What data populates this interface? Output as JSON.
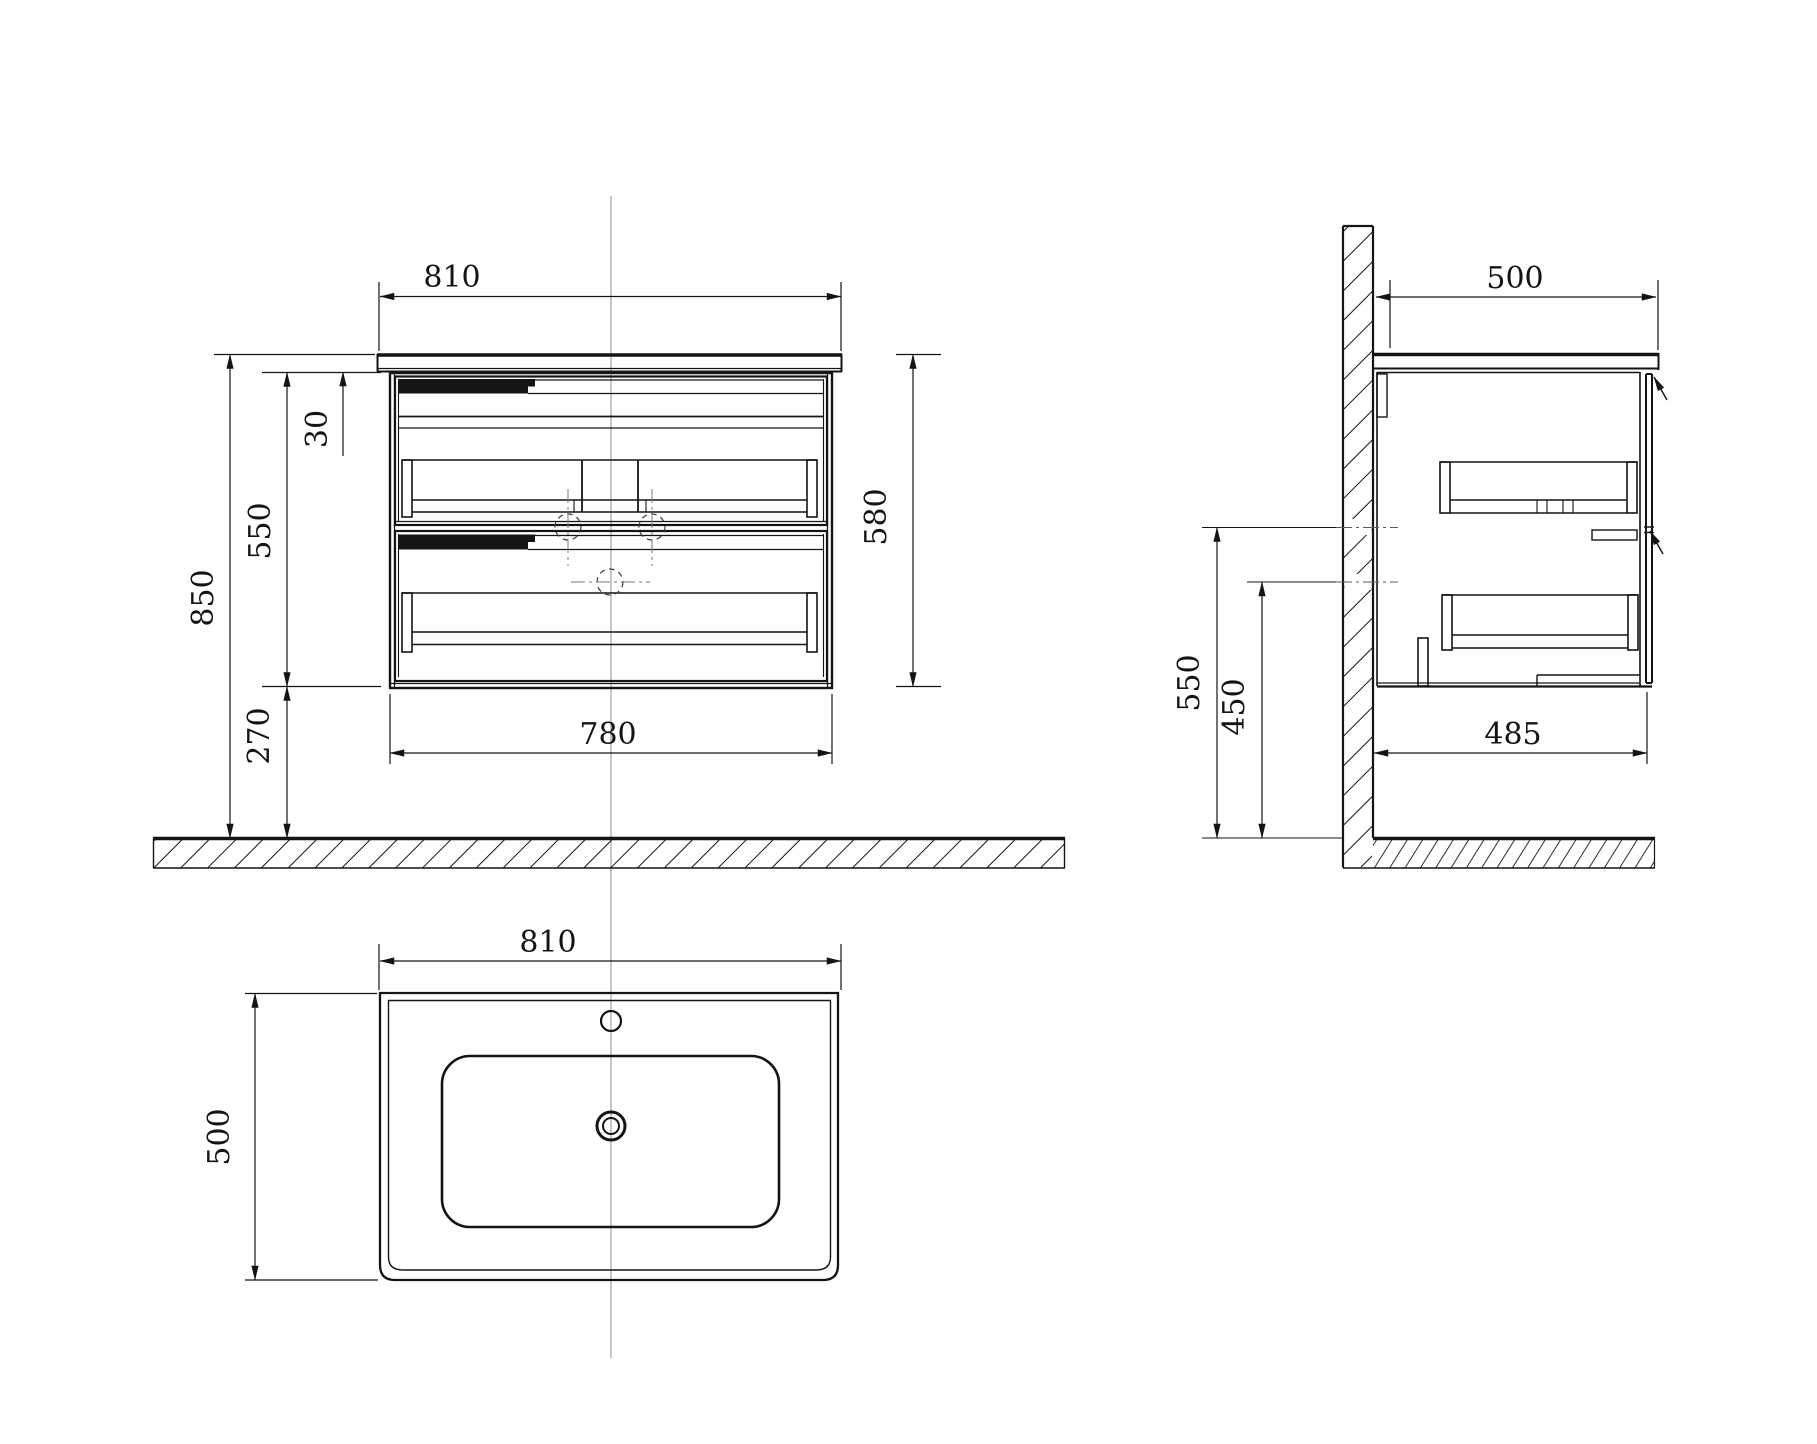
{
  "drawing": {
    "type": "technical-drawing",
    "subject": "wall-hung bathroom vanity cabinet with ceramic basin",
    "views": {
      "front": {
        "label": "front-view",
        "dims": {
          "top_width": "810",
          "counter_thickness": "30",
          "cabinet_height": "550",
          "overall_height": "850",
          "floor_clearance": "270",
          "cabinet_width": "780",
          "front_height": "580"
        }
      },
      "side": {
        "label": "side-view",
        "dims": {
          "top_depth": "500",
          "supply_height": "550",
          "drain_height": "450",
          "bottom_depth": "485"
        }
      },
      "top": {
        "label": "top-view",
        "dims": {
          "width": "810",
          "depth": "500"
        }
      }
    },
    "colors": {
      "line": "#141414",
      "centerline": "#999999",
      "background": "#ffffff"
    }
  }
}
